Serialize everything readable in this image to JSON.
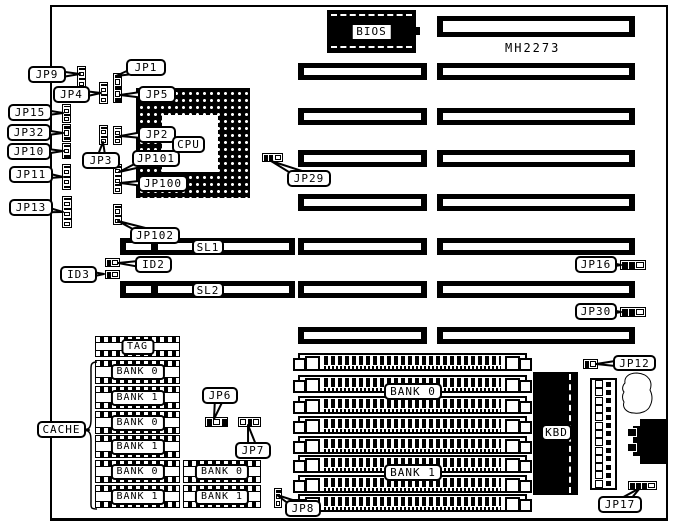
{
  "board": {
    "model": "MH2273",
    "outline": {
      "x": 50,
      "y": 5,
      "w": 618,
      "h": 516
    }
  },
  "bios": {
    "label": "BIOS",
    "x": 327,
    "y": 10,
    "w": 89,
    "h": 43
  },
  "cpu": {
    "x": 136,
    "y": 88,
    "w": 114,
    "h": 110,
    "hole": {
      "x": 26,
      "y": 27,
      "w": 56,
      "h": 57
    }
  },
  "kbd": {
    "x": 533,
    "y": 372,
    "w": 45,
    "h": 123
  },
  "pin_header": {
    "x": 590,
    "y": 378,
    "w": 27,
    "h": 112,
    "rows": 13
  },
  "slots": [
    {
      "x": 437,
      "y": 16,
      "w": 198,
      "h": 21
    },
    {
      "x": 437,
      "y": 63,
      "w": 198,
      "h": 17
    },
    {
      "x": 437,
      "y": 108,
      "w": 198,
      "h": 17
    },
    {
      "x": 437,
      "y": 150,
      "w": 198,
      "h": 17
    },
    {
      "x": 437,
      "y": 194,
      "w": 198,
      "h": 17
    },
    {
      "x": 437,
      "y": 238,
      "w": 198,
      "h": 17
    },
    {
      "x": 437,
      "y": 281,
      "w": 198,
      "h": 17
    },
    {
      "x": 437,
      "y": 327,
      "w": 198,
      "h": 17
    },
    {
      "x": 298,
      "y": 63,
      "w": 129,
      "h": 17
    },
    {
      "x": 298,
      "y": 108,
      "w": 129,
      "h": 17
    },
    {
      "x": 298,
      "y": 150,
      "w": 129,
      "h": 17
    },
    {
      "x": 298,
      "y": 194,
      "w": 129,
      "h": 17
    },
    {
      "x": 298,
      "y": 238,
      "w": 129,
      "h": 17
    },
    {
      "x": 298,
      "y": 281,
      "w": 129,
      "h": 17
    },
    {
      "x": 298,
      "y": 327,
      "w": 129,
      "h": 17
    },
    {
      "x": 120,
      "y": 238,
      "w": 175,
      "h": 17,
      "divider": 31
    },
    {
      "x": 120,
      "y": 281,
      "w": 175,
      "h": 17,
      "divider": 31
    }
  ],
  "jumpers": [
    {
      "name": "jp9-jumper",
      "x": 77,
      "y": 66,
      "w": 9,
      "h": 22,
      "orient": "v",
      "cells": [
        1,
        0,
        1,
        0
      ]
    },
    {
      "name": "jp4-jumper",
      "x": 99,
      "y": 82,
      "w": 9,
      "h": 22,
      "orient": "v",
      "cells": [
        1,
        0,
        1,
        0
      ]
    },
    {
      "name": "jp1-jp5-jumper",
      "x": 113,
      "y": 73,
      "w": 9,
      "h": 30,
      "orient": "v",
      "cells": [
        1,
        0,
        1,
        0,
        1
      ]
    },
    {
      "name": "jp15-jumper",
      "x": 62,
      "y": 104,
      "w": 9,
      "h": 19,
      "orient": "v",
      "cells": [
        1,
        0,
        1,
        0
      ]
    },
    {
      "name": "jp32-jumper",
      "x": 62,
      "y": 124,
      "w": 9,
      "h": 18,
      "orient": "v",
      "cells": [
        1,
        0,
        1
      ]
    },
    {
      "name": "jp10-jumper",
      "x": 62,
      "y": 143,
      "w": 9,
      "h": 16,
      "orient": "v",
      "cells": [
        1,
        0,
        1
      ]
    },
    {
      "name": "jp11-jumper",
      "x": 62,
      "y": 164,
      "w": 9,
      "h": 26,
      "orient": "v",
      "cells": [
        1,
        0,
        1,
        0,
        1
      ]
    },
    {
      "name": "jp13-jumper",
      "x": 62,
      "y": 196,
      "w": 10,
      "h": 32,
      "orient": "v",
      "cells": [
        1,
        0,
        1,
        0,
        1,
        0
      ]
    },
    {
      "name": "jp3-jumper",
      "x": 99,
      "y": 125,
      "w": 9,
      "h": 20,
      "orient": "v",
      "cells": [
        1,
        0,
        1,
        0
      ]
    },
    {
      "name": "jp2-jumper",
      "x": 113,
      "y": 126,
      "w": 9,
      "h": 19,
      "orient": "v",
      "cells": [
        1,
        0,
        1,
        0
      ]
    },
    {
      "name": "jp101-jp100-jumper",
      "x": 113,
      "y": 164,
      "w": 9,
      "h": 30,
      "orient": "v",
      "cells": [
        1,
        0,
        1,
        0,
        1,
        0
      ]
    },
    {
      "name": "jp102-jumper",
      "x": 113,
      "y": 204,
      "w": 9,
      "h": 21,
      "orient": "v",
      "cells": [
        1,
        0,
        1,
        0
      ]
    },
    {
      "name": "jp29-jumper",
      "x": 262,
      "y": 153,
      "w": 21,
      "h": 9,
      "orient": "h",
      "cells": [
        1,
        1,
        0
      ]
    },
    {
      "name": "id2-jumper",
      "x": 105,
      "y": 258,
      "w": 15,
      "h": 9,
      "orient": "h",
      "cells": [
        1,
        0
      ]
    },
    {
      "name": "id3-jumper",
      "x": 105,
      "y": 270,
      "w": 15,
      "h": 9,
      "orient": "h",
      "cells": [
        1,
        0
      ]
    },
    {
      "name": "jp16-jumper",
      "x": 620,
      "y": 260,
      "w": 26,
      "h": 10,
      "orient": "h",
      "cells": [
        1,
        1,
        0
      ]
    },
    {
      "name": "jp30-jumper",
      "x": 620,
      "y": 307,
      "w": 26,
      "h": 10,
      "orient": "h",
      "cells": [
        1,
        1,
        0
      ]
    },
    {
      "name": "jp6-jumper",
      "x": 205,
      "y": 417,
      "w": 23,
      "h": 10,
      "orient": "h",
      "cells": [
        1,
        0,
        1
      ]
    },
    {
      "name": "jp7-jumper",
      "x": 238,
      "y": 417,
      "w": 23,
      "h": 10,
      "orient": "h",
      "cells": [
        0,
        1,
        0
      ]
    },
    {
      "name": "jp8-jumper",
      "x": 274,
      "y": 488,
      "w": 8,
      "h": 20,
      "orient": "v",
      "cells": [
        1,
        0,
        0
      ]
    },
    {
      "name": "jp12-jumper",
      "x": 583,
      "y": 359,
      "w": 15,
      "h": 10,
      "orient": "h",
      "cells": [
        1,
        0
      ]
    },
    {
      "name": "jp17-jumper",
      "x": 628,
      "y": 481,
      "w": 29,
      "h": 9,
      "orient": "h",
      "cells": [
        1,
        1,
        1,
        0
      ]
    }
  ],
  "cache_chips": [
    {
      "label": "TAG",
      "x": 95,
      "y": 336,
      "w": 85,
      "h": 21
    },
    {
      "label": "BANK 0",
      "x": 95,
      "y": 360,
      "w": 85,
      "h": 24
    },
    {
      "label": "BANK 1",
      "x": 95,
      "y": 386,
      "w": 85,
      "h": 23
    },
    {
      "label": "BANK 0",
      "x": 95,
      "y": 411,
      "w": 85,
      "h": 23
    },
    {
      "label": "BANK 1",
      "x": 95,
      "y": 435,
      "w": 85,
      "h": 23
    },
    {
      "label": "BANK 0",
      "x": 95,
      "y": 460,
      "w": 85,
      "h": 23
    },
    {
      "label": "BANK 1",
      "x": 95,
      "y": 485,
      "w": 85,
      "h": 23
    },
    {
      "label": "BANK 0",
      "x": 183,
      "y": 460,
      "w": 78,
      "h": 23
    },
    {
      "label": "BANK 1",
      "x": 183,
      "y": 485,
      "w": 78,
      "h": 23
    }
  ],
  "simms": [
    {
      "x": 298,
      "y": 353,
      "w": 229,
      "h": 18
    },
    {
      "x": 298,
      "y": 375,
      "w": 229,
      "h": 18
    },
    {
      "x": 298,
      "y": 396,
      "w": 229,
      "h": 18
    },
    {
      "x": 298,
      "y": 416,
      "w": 229,
      "h": 18
    },
    {
      "x": 298,
      "y": 436,
      "w": 229,
      "h": 18
    },
    {
      "x": 298,
      "y": 455,
      "w": 229,
      "h": 18
    },
    {
      "x": 298,
      "y": 475,
      "w": 229,
      "h": 18
    },
    {
      "x": 298,
      "y": 494,
      "w": 229,
      "h": 18
    }
  ],
  "labels": [
    {
      "id": "jp9",
      "text": "JP9",
      "x": 28,
      "y": 66,
      "w": 38,
      "h": 17,
      "tail": [
        80,
        74
      ]
    },
    {
      "id": "jp4",
      "text": "JP4",
      "x": 53,
      "y": 86,
      "w": 37,
      "h": 17,
      "tail": [
        101,
        93
      ]
    },
    {
      "id": "jp1",
      "text": "JP1",
      "x": 126,
      "y": 59,
      "w": 40,
      "h": 17,
      "tail": [
        116,
        76
      ]
    },
    {
      "id": "jp5",
      "text": "JP5",
      "x": 138,
      "y": 86,
      "w": 38,
      "h": 17,
      "tail": [
        120,
        95
      ]
    },
    {
      "id": "jp15",
      "text": "JP15",
      "x": 8,
      "y": 104,
      "w": 44,
      "h": 17,
      "tail": [
        63,
        113
      ]
    },
    {
      "id": "jp32",
      "text": "JP32",
      "x": 7,
      "y": 124,
      "w": 44,
      "h": 17,
      "tail": [
        63,
        133
      ]
    },
    {
      "id": "jp10",
      "text": "JP10",
      "x": 7,
      "y": 143,
      "w": 44,
      "h": 17,
      "tail": [
        63,
        151
      ]
    },
    {
      "id": "jp11",
      "text": "JP11",
      "x": 9,
      "y": 166,
      "w": 44,
      "h": 17,
      "tail": [
        63,
        177
      ]
    },
    {
      "id": "jp13",
      "text": "JP13",
      "x": 9,
      "y": 199,
      "w": 44,
      "h": 17,
      "tail": [
        63,
        212
      ]
    },
    {
      "id": "jp2",
      "text": "JP2",
      "x": 138,
      "y": 126,
      "w": 38,
      "h": 17,
      "tail": [
        120,
        136
      ]
    },
    {
      "id": "jp3",
      "text": "JP3",
      "x": 82,
      "y": 152,
      "w": 38,
      "h": 17,
      "tail": [
        103,
        142
      ]
    },
    {
      "id": "jp101",
      "text": "JP101",
      "x": 132,
      "y": 150,
      "w": 48,
      "h": 17,
      "tail": [
        119,
        172
      ]
    },
    {
      "id": "jp100",
      "text": "JP100",
      "x": 138,
      "y": 175,
      "w": 50,
      "h": 17,
      "tail": [
        120,
        183
      ]
    },
    {
      "id": "jp102",
      "text": "JP102",
      "x": 130,
      "y": 227,
      "w": 50,
      "h": 17,
      "tail": [
        118,
        221
      ]
    },
    {
      "id": "jp29",
      "text": "JP29",
      "x": 287,
      "y": 170,
      "w": 44,
      "h": 17,
      "tail": [
        271,
        161
      ]
    },
    {
      "id": "sl1",
      "text": "SL1",
      "x": 192,
      "y": 239,
      "w": 32,
      "h": 16,
      "tail": null
    },
    {
      "id": "id2",
      "text": "ID2",
      "x": 135,
      "y": 256,
      "w": 37,
      "h": 17,
      "tail": [
        118,
        263
      ]
    },
    {
      "id": "id3",
      "text": "ID3",
      "x": 60,
      "y": 266,
      "w": 37,
      "h": 17,
      "tail": [
        104,
        274
      ]
    },
    {
      "id": "sl2",
      "text": "SL2",
      "x": 192,
      "y": 282,
      "w": 32,
      "h": 16,
      "tail": null
    },
    {
      "id": "jp16",
      "text": "JP16",
      "x": 575,
      "y": 256,
      "w": 42,
      "h": 17,
      "tail": [
        621,
        265
      ]
    },
    {
      "id": "jp30",
      "text": "JP30",
      "x": 575,
      "y": 303,
      "w": 42,
      "h": 17,
      "tail": [
        621,
        312
      ]
    },
    {
      "id": "cache",
      "text": "CACHE",
      "x": 37,
      "y": 421,
      "w": 49,
      "h": 17,
      "tail": [
        89,
        430
      ]
    },
    {
      "id": "jp6",
      "text": "JP6",
      "x": 202,
      "y": 387,
      "w": 36,
      "h": 17,
      "tail": [
        214,
        419
      ]
    },
    {
      "id": "jp7",
      "text": "JP7",
      "x": 235,
      "y": 442,
      "w": 36,
      "h": 17,
      "tail": [
        248,
        425
      ]
    },
    {
      "id": "bank0-simm",
      "text": "BANK 0",
      "x": 384,
      "y": 383,
      "w": 58,
      "h": 17,
      "tail": null
    },
    {
      "id": "bank1-simm",
      "text": "BANK 1",
      "x": 384,
      "y": 464,
      "w": 58,
      "h": 17,
      "tail": null
    },
    {
      "id": "jp8",
      "text": "JP8",
      "x": 285,
      "y": 500,
      "w": 36,
      "h": 17,
      "tail": [
        277,
        495
      ]
    },
    {
      "id": "kbd",
      "text": "KBD",
      "x": 541,
      "y": 424,
      "w": 31,
      "h": 17,
      "tail": null
    },
    {
      "id": "jp12",
      "text": "JP12",
      "x": 613,
      "y": 355,
      "w": 43,
      "h": 16,
      "tail": [
        596,
        364
      ]
    },
    {
      "id": "jp17",
      "text": "JP17",
      "x": 598,
      "y": 496,
      "w": 44,
      "h": 17,
      "tail": [
        640,
        488
      ]
    },
    {
      "id": "cpu",
      "text": "CPU",
      "x": 172,
      "y": 136,
      "w": 33,
      "h": 17,
      "tail": null
    }
  ],
  "shapes": {
    "cache_brace": "M97,362 C90,362 91,366 91,373 L91,419 C91,426 90,429 85,430 C90,431 91,434 91,441 L91,501 C91,507 90,509 97,509",
    "crystal_blob": "M637,373 c-8,0 -13,4 -12,10 c-3,3 -3,7 -1,9 c-2,3 -2,7 0,10 c-2,6 3,11 10,11 c7,1 14,-2 16,-7 c3,-6 2,-12 0,-16 c3,-8 -1,-16 -13,-17 z",
    "din_body": {
      "x": 640,
      "y": 419,
      "w": 27,
      "h": 45
    },
    "din_ext": {
      "x": 633,
      "y": 426,
      "w": 8,
      "h": 30
    },
    "din_tabs": [
      {
        "x": 627,
        "y": 428,
        "w": 10,
        "h": 9
      },
      {
        "x": 627,
        "y": 443,
        "w": 10,
        "h": 9
      }
    ]
  },
  "colors": {
    "ink": "#000000",
    "paper": "#ffffff"
  }
}
